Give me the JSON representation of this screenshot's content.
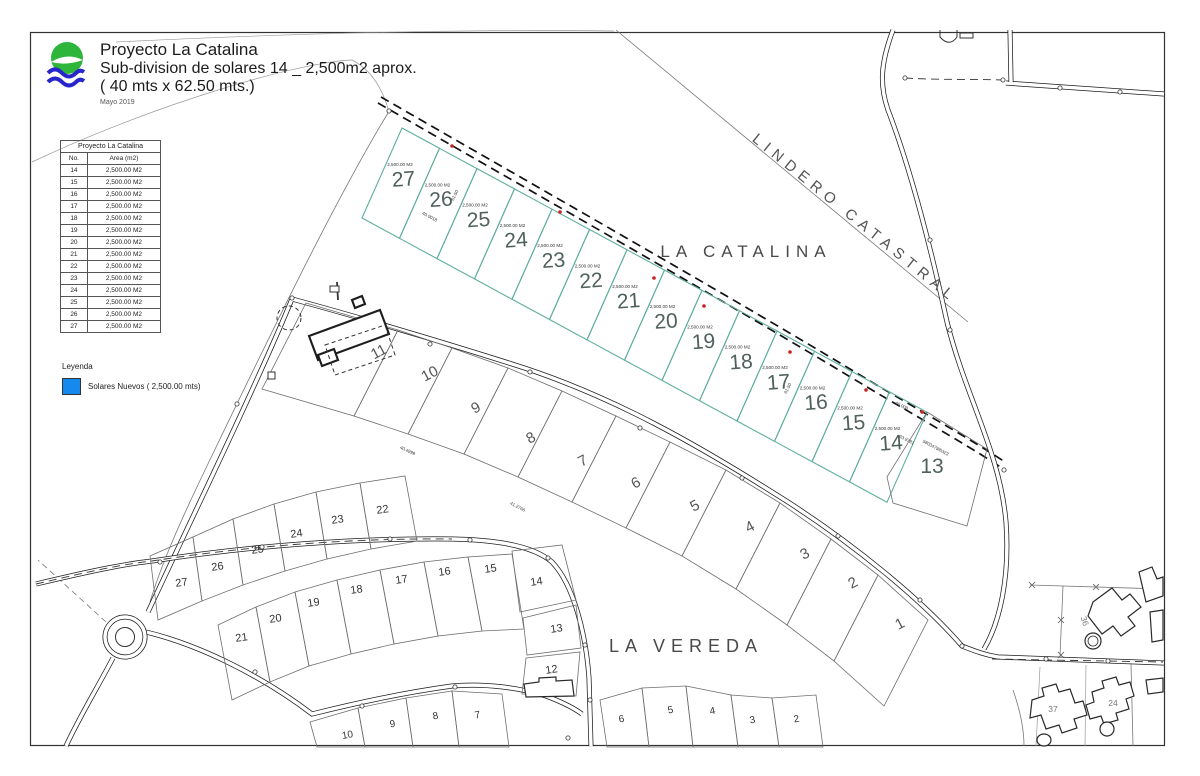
{
  "title_block": {
    "project": "Proyecto La Catalina",
    "subtitle": "Sub-division de solares 14 _ 2,500m2 aprox.",
    "dimensions": "( 40 mts x 62.50 mts.)",
    "date": "Mayo 2019"
  },
  "table": {
    "title": "Proyecto La Catalina",
    "col_no": "No.",
    "col_area": "Area (m2)",
    "rows": [
      [
        "14",
        "2,500.00 M2"
      ],
      [
        "15",
        "2,500.00 M2"
      ],
      [
        "16",
        "2,500.00 M2"
      ],
      [
        "17",
        "2,500.00 M2"
      ],
      [
        "18",
        "2,500.00 M2"
      ],
      [
        "19",
        "2,500.00 M2"
      ],
      [
        "20",
        "2,500.00 M2"
      ],
      [
        "21",
        "2,500.00 M2"
      ],
      [
        "22",
        "2,500.00 M2"
      ],
      [
        "23",
        "2,500.00 M2"
      ],
      [
        "24",
        "2,500.00 M2"
      ],
      [
        "25",
        "2,500.00 M2"
      ],
      [
        "26",
        "2,500.00 M2"
      ],
      [
        "27",
        "2,500.00 M2"
      ]
    ]
  },
  "legend": {
    "title": "Leyenda",
    "item": {
      "label": "Solares Nuevos ( 2,500.00 mts)",
      "color": "#1589ee"
    }
  },
  "map": {
    "labels": {
      "catalina": "LA CATALINA",
      "vereda": "LA VEREDA",
      "lindero": "LINDERO CATASTRAL"
    },
    "new_lots": [
      {
        "no": "27",
        "area": "2,500.00 M2"
      },
      {
        "no": "26",
        "area": "2,500.00 M2"
      },
      {
        "no": "25",
        "area": "2,500.00 M2"
      },
      {
        "no": "24",
        "area": "2,500.00 M2"
      },
      {
        "no": "23",
        "area": "2,500.00 M2"
      },
      {
        "no": "22",
        "area": "2,500.00 M2"
      },
      {
        "no": "21",
        "area": "2,500.00 M2"
      },
      {
        "no": "20",
        "area": "2,500.00 M2"
      },
      {
        "no": "19",
        "area": "2,500.00 M2"
      },
      {
        "no": "18",
        "area": "2,500.00 M2"
      },
      {
        "no": "17",
        "area": "2,500.00 M2"
      },
      {
        "no": "16",
        "area": "2,500.00 M2"
      },
      {
        "no": "15",
        "area": "2,500.00 M2"
      },
      {
        "no": "14",
        "area": "2,500.00 M2"
      }
    ],
    "lot13": {
      "no": "13"
    },
    "middle_lots": [
      "11",
      "10",
      "9",
      "8",
      "7",
      "6",
      "5",
      "4",
      "3",
      "2",
      "1"
    ],
    "south_upper_lots": [
      "27",
      "26",
      "25",
      "24",
      "23",
      "22"
    ],
    "south_lower_lots": [
      "21",
      "20",
      "19",
      "18",
      "17",
      "16",
      "15",
      "14",
      "13",
      "12"
    ],
    "bottom_left_lots": [
      "10",
      "9",
      "8",
      "7"
    ],
    "bottom_right_lots": [
      "6",
      "5",
      "4",
      "3",
      "2"
    ],
    "house_lots": [
      "36",
      "37",
      "24"
    ],
    "dims": [
      "61.50",
      "40.0018",
      "40.4999",
      "41.2766",
      "61.50",
      "40.008",
      "63.9781",
      "5803479/6323"
    ]
  }
}
